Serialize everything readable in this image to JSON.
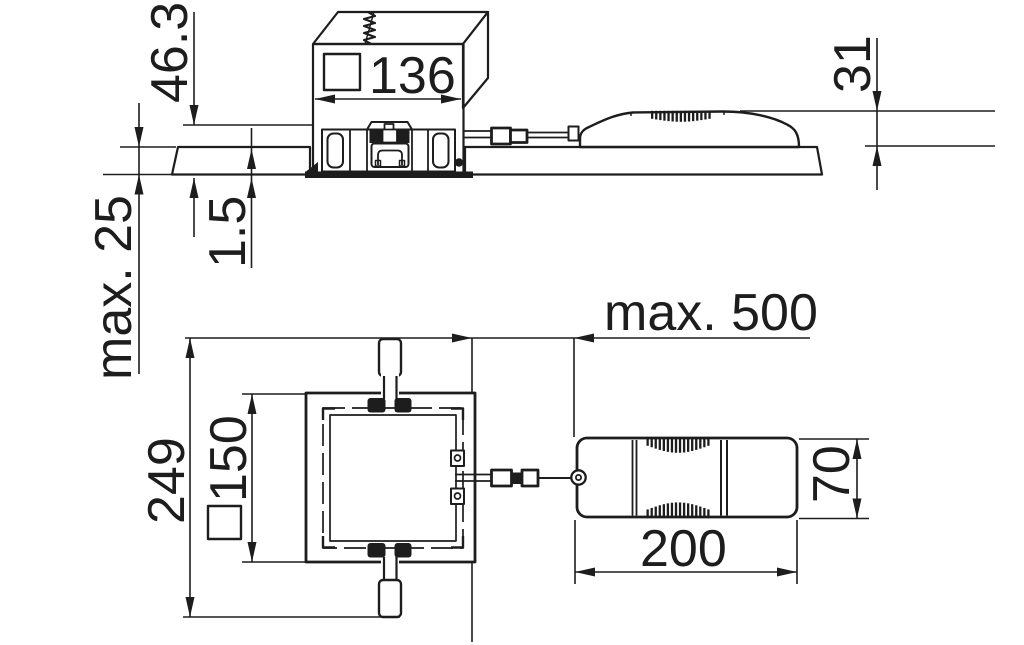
{
  "diagram": {
    "type": "technical-dimension-drawing",
    "views": {
      "top": "section view",
      "bottom": "plan view"
    },
    "labels": {
      "cutout_width": "136",
      "fixture_height": "46.3",
      "ceiling_thickness_max": "max. 25",
      "trim_height": "1.5",
      "driver_height": "31",
      "cable_length_max": "max. 500",
      "overall_size": "249",
      "frame_size": "150",
      "driver_length": "200",
      "driver_width": "70"
    },
    "colors": {
      "ink": "#1d1d1d",
      "background": "#ffffff"
    }
  }
}
